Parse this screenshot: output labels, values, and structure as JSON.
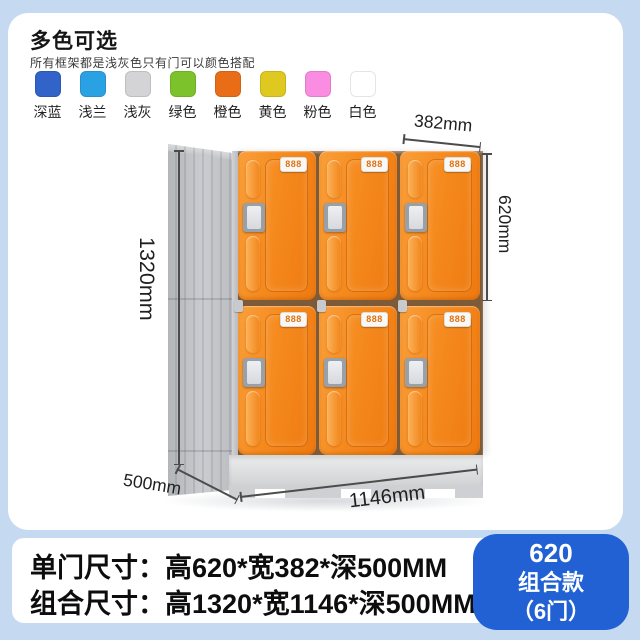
{
  "page": {
    "background": "#c5d9f1",
    "panel_background": "#ffffff"
  },
  "color_options": {
    "title": "多色可选",
    "subtitle": "所有框架都是浅灰色只有门可以颜色搭配",
    "swatches": [
      {
        "label": "深蓝",
        "color": "#3263c8"
      },
      {
        "label": "浅兰",
        "color": "#2aa1e3"
      },
      {
        "label": "浅灰",
        "color": "#d4d4d6"
      },
      {
        "label": "绿色",
        "color": "#7cc32b"
      },
      {
        "label": "橙色",
        "color": "#e96d17"
      },
      {
        "label": "黄色",
        "color": "#dfc81f"
      },
      {
        "label": "粉色",
        "color": "#fa8ce2"
      },
      {
        "label": "白色",
        "color": "#ffffff"
      }
    ]
  },
  "locker": {
    "door_label": "888",
    "rows": 2,
    "columns": 3,
    "door_color": "#f58a1e",
    "frame_color": "#c9cacd"
  },
  "dimensions": {
    "single_door_width": "382mm",
    "single_door_height": "620mm",
    "total_height": "1320mm",
    "depth": "500mm",
    "total_width": "1146mm"
  },
  "specs": {
    "single_door": "单门尺寸：高620*宽382*深500MM",
    "combined": "组合尺寸：高1320*宽1146*深500MM"
  },
  "badge": {
    "model": "620",
    "type": "组合款",
    "doors": "（6门）",
    "color": "#2161d4"
  }
}
